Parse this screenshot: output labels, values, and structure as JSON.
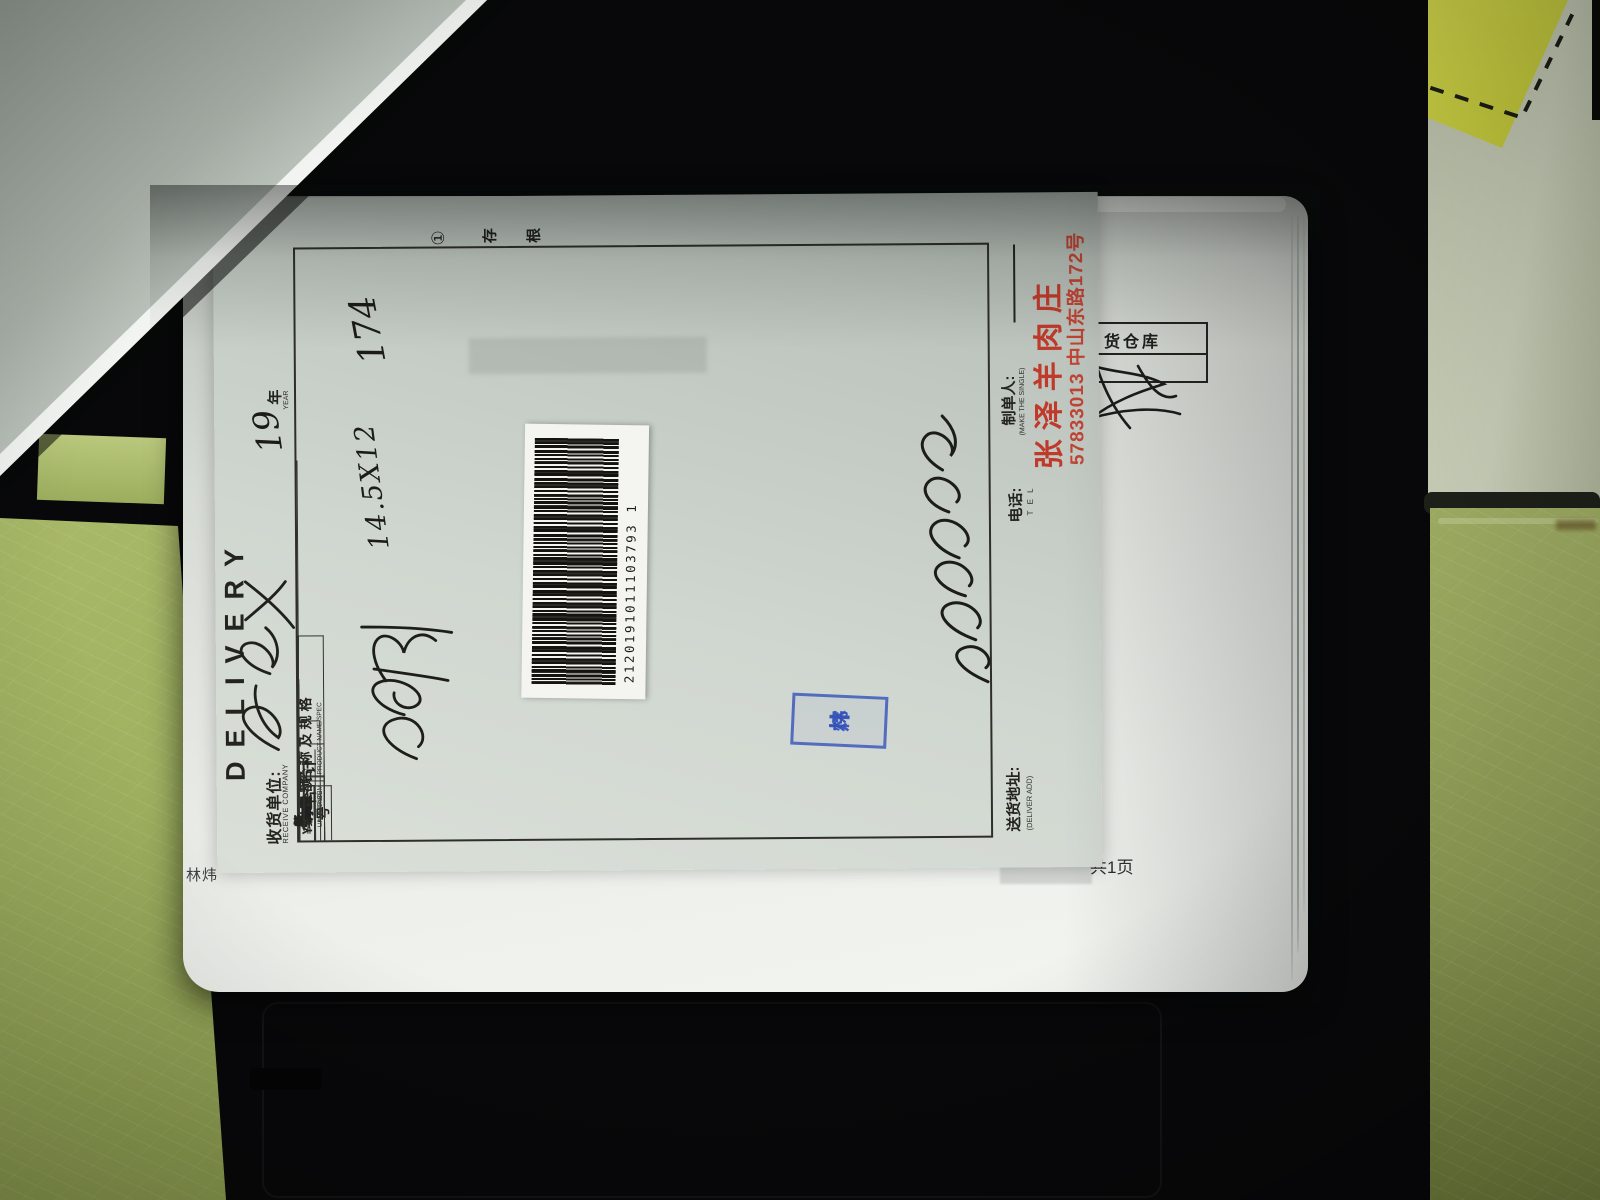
{
  "stub": {
    "circled_number": "①",
    "label": "存根"
  },
  "title": {
    "en": "DELIVERY"
  },
  "receive": {
    "label_zh": "收货单位:",
    "label_en": "RECEIVE COMPANY",
    "value_handwritten": "皇宫"
  },
  "date": {
    "year_value": "19",
    "year_label": "年",
    "year_label_en": "YEAR"
  },
  "table": {
    "headers": {
      "no_zh": "序号",
      "name_zh": "名称及规格",
      "name_en": "PRODUCT NAME/SPEC",
      "unit_zh": "单位",
      "unit_en": "UNIT",
      "qty_zh": "数量",
      "qty_en": "AMOUNT",
      "price_zh": "单价",
      "price_en": "UNIT PRICE",
      "sum_zh": "金额",
      "sum_en": "SUM"
    },
    "rows": [
      {
        "no": "1",
        "name_handwritten": "羊小排",
        "qty_handwritten": "14.5X12",
        "sum_handwritten": "174"
      },
      {
        "no": "2"
      },
      {
        "no": "3"
      },
      {
        "no": "4"
      },
      {
        "no": "5"
      },
      {
        "no": "6"
      },
      {
        "no": "7"
      },
      {
        "no": "8"
      },
      {
        "no": "9"
      },
      {
        "no": "10"
      },
      {
        "no": "11"
      },
      {
        "no": "12"
      },
      {
        "no": "13"
      },
      {
        "no": "14"
      },
      {
        "no": "15"
      }
    ],
    "total_row": {
      "label": "合计",
      "digits": [
        "拾",
        "万",
        "仟",
        "佰",
        "拾",
        "元",
        "角",
        "分"
      ],
      "currency": "¥",
      "amount_in_words_handwritten": "壹佰柒拾肆元整"
    }
  },
  "footer": {
    "deliver_add_label": "送货地址:",
    "deliver_add_en": "(DELIVER ADD)",
    "tel_label": "电话:",
    "tel_en": "T E L",
    "maker_label": "制单人:",
    "maker_en": "(MAKE THE SINGLE)"
  },
  "seller": {
    "name": "张泽羊肉庄",
    "phone_address": "57833013 中山东路172号",
    "color": "#bf3a2b"
  },
  "barcode": {
    "number": "2120191011103793  1"
  },
  "stamp": {
    "char_top": "林",
    "char_bottom": "炜",
    "color": "#3a56ba"
  },
  "backing_page": {
    "printed_name": "林炜",
    "page_count": "共1页",
    "warehouse_label": "货仓库"
  }
}
